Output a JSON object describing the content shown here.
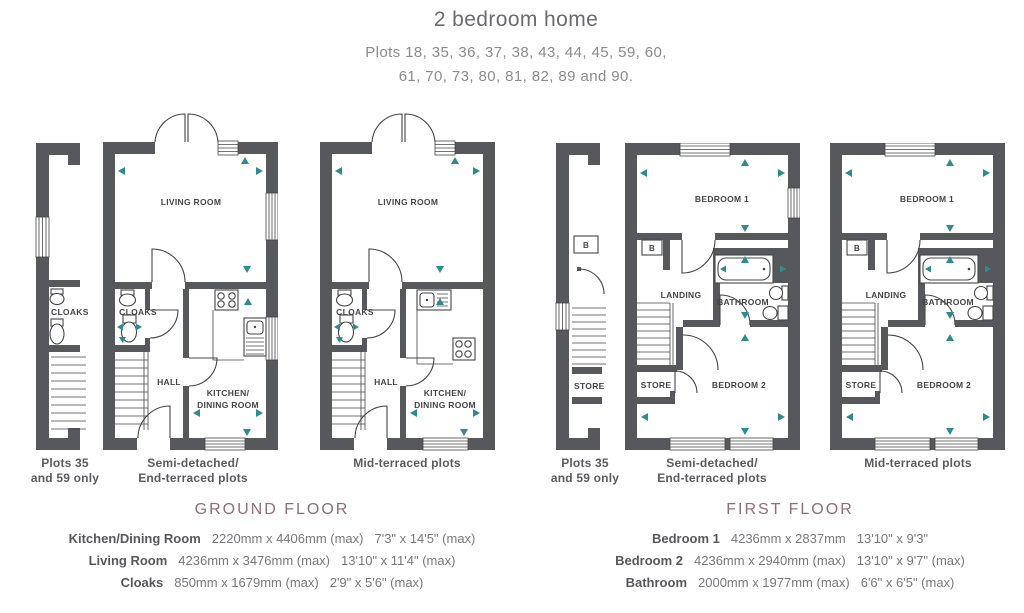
{
  "title": "2 bedroom home",
  "subtitle_line1": "Plots 18, 35, 36, 37, 38, 43, 44, 45, 59, 60,",
  "subtitle_line2": "61, 70, 73, 80, 81, 82, 89 and 90.",
  "colors": {
    "wall": "#57585b",
    "line": "#454547",
    "dimension_arrow": "#2e8b90",
    "floor_heading": "#8f6e7b",
    "text_dark": "#57585b",
    "text_mid": "#77787b"
  },
  "captions": {
    "plots_line1": "Plots 35",
    "plots_line2": "and 59 only",
    "semi_line1": "Semi-detached/",
    "semi_line2": "End-terraced plots",
    "mid": "Mid-terraced plots"
  },
  "ground": {
    "heading": "GROUND FLOOR",
    "rooms": {
      "living": "LIVING ROOM",
      "cloaks": "CLOAKS",
      "hall": "HALL",
      "kitchen_line1": "KITCHEN/",
      "kitchen_line2": "DINING ROOM"
    },
    "dimensions": [
      {
        "name": "Kitchen/Dining Room",
        "metric": "2220mm x 4406mm (max)",
        "imperial": "7'3\" x 14'5\" (max)"
      },
      {
        "name": "Living Room",
        "metric": "4236mm x 3476mm (max)",
        "imperial": "13'10\" x 11'4\" (max)"
      },
      {
        "name": "Cloaks",
        "metric": "850mm x 1679mm (max)",
        "imperial": "2'9\" x 5'6\" (max)"
      }
    ]
  },
  "first": {
    "heading": "FIRST FLOOR",
    "rooms": {
      "bedroom1": "BEDROOM 1",
      "boiler": "B",
      "landing": "LANDING",
      "bathroom": "BATHROOM",
      "store": "STORE",
      "bedroom2": "BEDROOM 2"
    },
    "dimensions": [
      {
        "name": "Bedroom 1",
        "metric": "4236mm x 2837mm",
        "imperial": "13'10\" x 9'3\""
      },
      {
        "name": "Bedroom 2",
        "metric": "4236mm x 2940mm (max)",
        "imperial": "13'10\" x 9'7\" (max)"
      },
      {
        "name": "Bathroom",
        "metric": "2000mm x 1977mm (max)",
        "imperial": "6'6\" x 6'5\" (max)"
      }
    ]
  }
}
